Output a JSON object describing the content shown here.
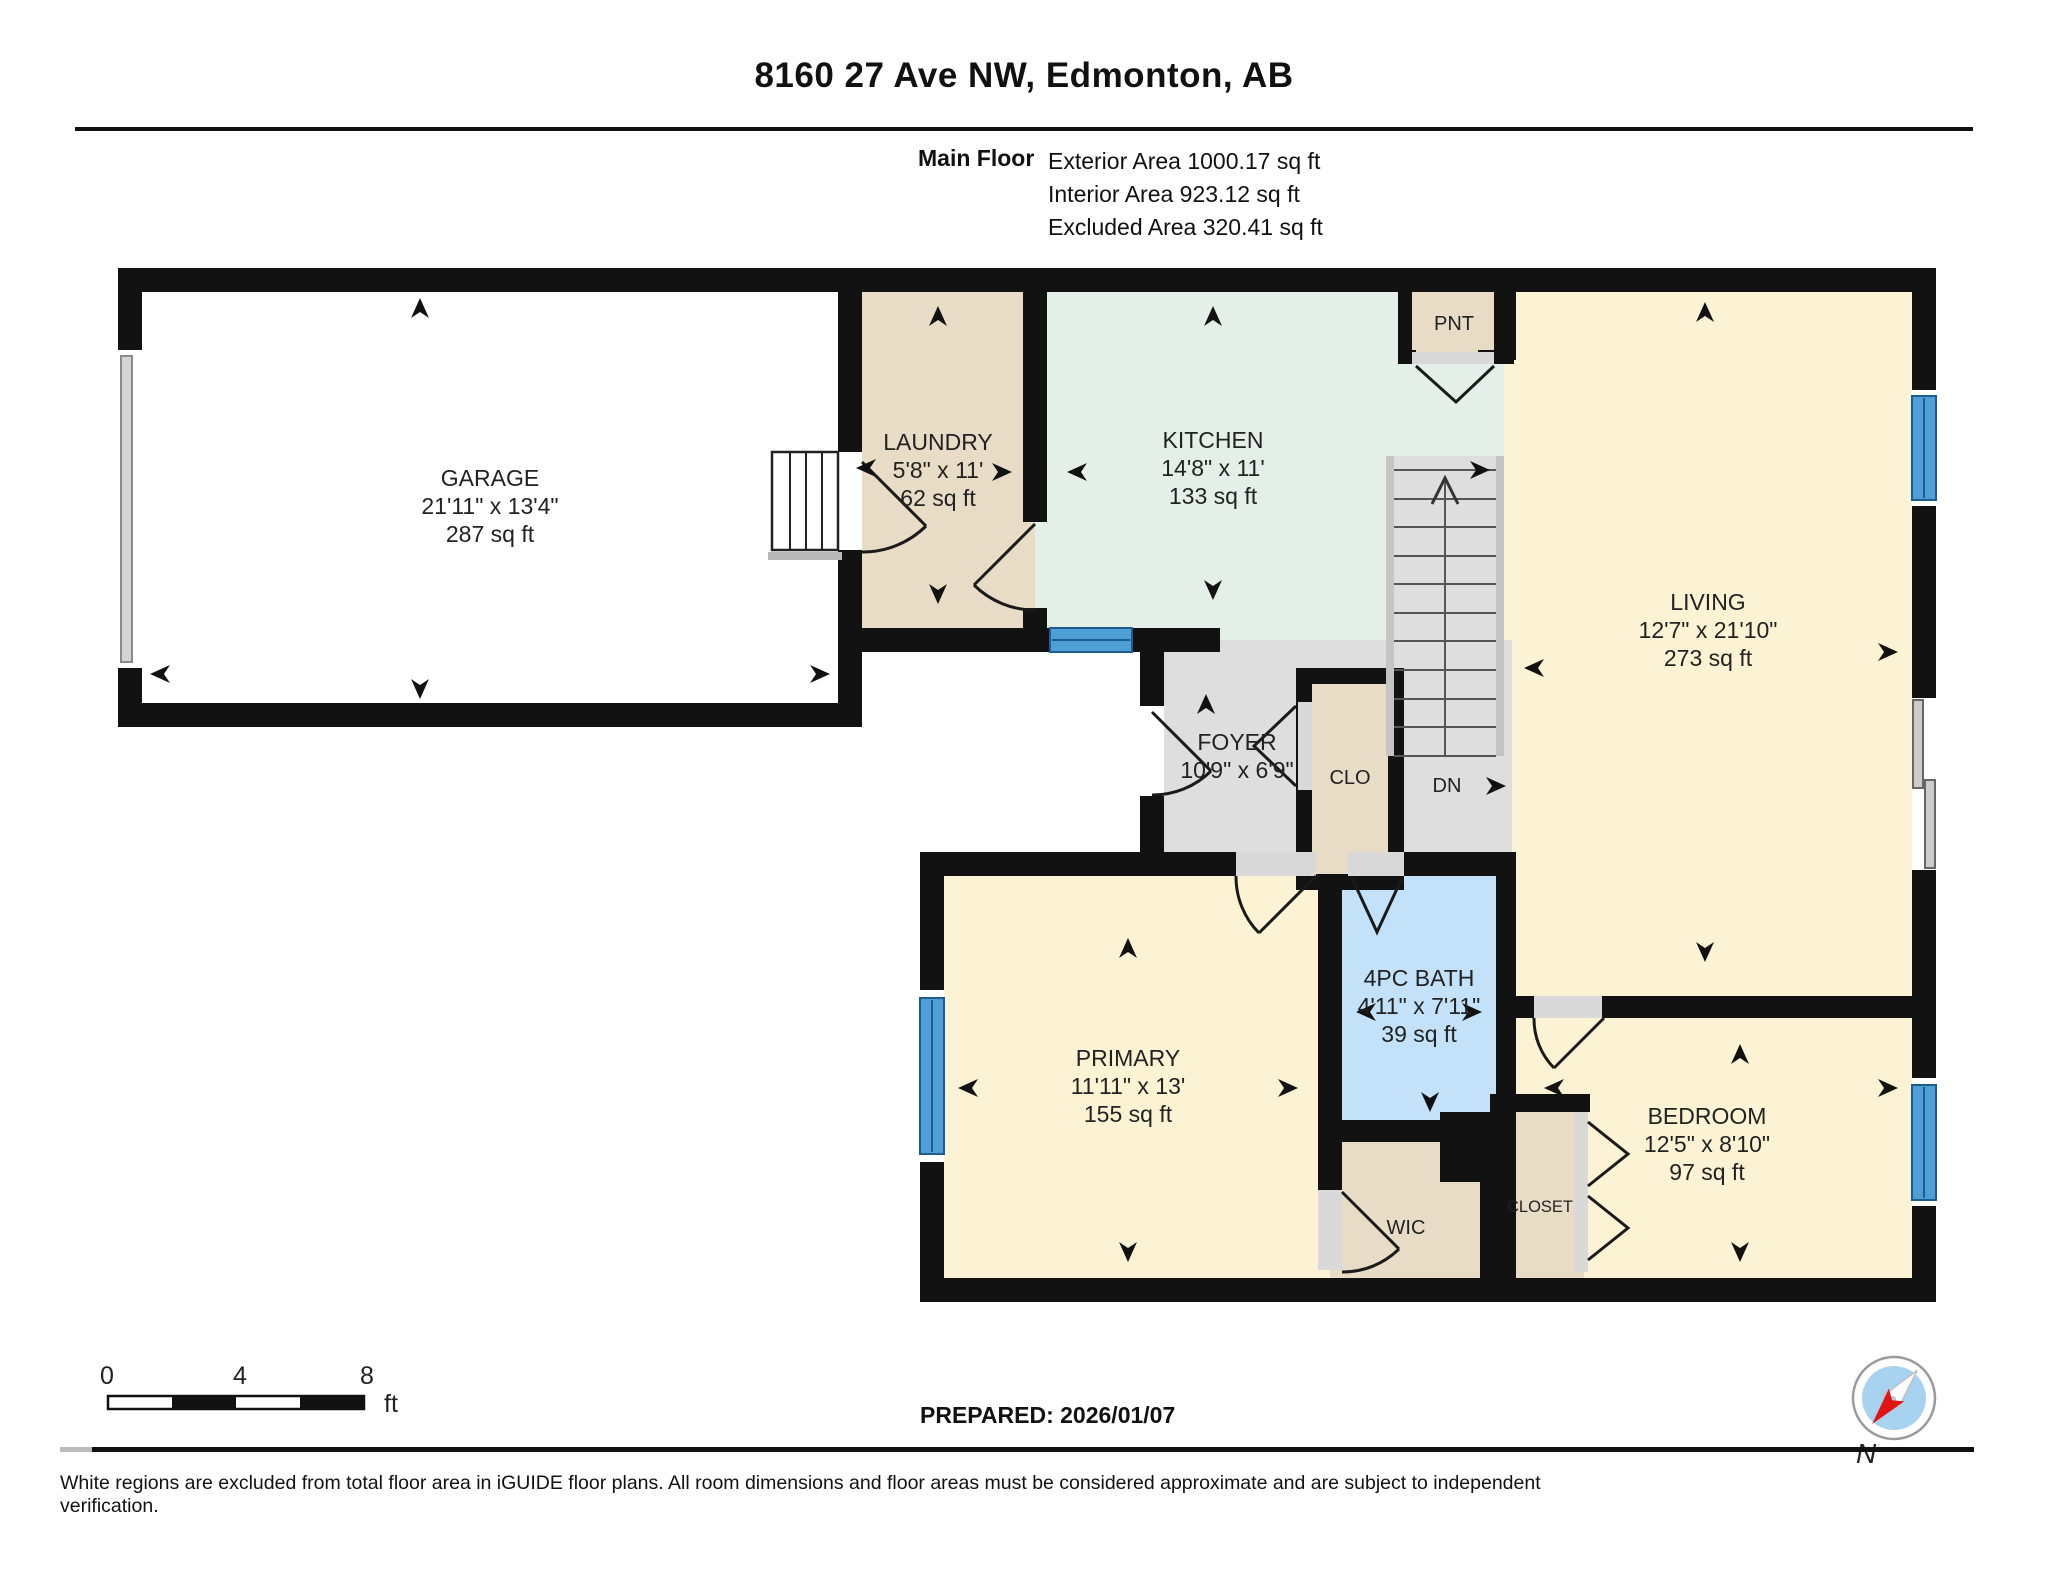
{
  "header": {
    "title": "8160 27 Ave NW, Edmonton, AB",
    "floor_label": "Main Floor",
    "exterior_area": "Exterior Area 1000.17 sq ft",
    "interior_area": "Interior Area 923.12 sq ft",
    "excluded_area": "Excluded Area 320.41 sq ft"
  },
  "rooms": {
    "garage": {
      "name": "GARAGE",
      "dims": "21'11\" x 13'4\"",
      "area": "287 sq ft"
    },
    "laundry": {
      "name": "LAUNDRY",
      "dims": "5'8\" x 11'",
      "area": "62 sq ft"
    },
    "kitchen": {
      "name": "KITCHEN",
      "dims": "14'8\" x 11'",
      "area": "133 sq ft"
    },
    "pantry": {
      "name": "PNT"
    },
    "living": {
      "name": "LIVING",
      "dims": "12'7\" x 21'10\"",
      "area": "273 sq ft"
    },
    "foyer": {
      "name": "FOYER",
      "dims": "10'9\" x 6'9\""
    },
    "closet_foyer": {
      "name": "CLO"
    },
    "stairs": {
      "down_label": "DN"
    },
    "primary": {
      "name": "PRIMARY",
      "dims": "11'11\" x 13'",
      "area": "155 sq ft"
    },
    "bath": {
      "name": "4PC BATH",
      "dims": "4'11\" x 7'11\"",
      "area": "39 sq ft"
    },
    "bedroom": {
      "name": "BEDROOM",
      "dims": "12'5\" x 8'10\"",
      "area": "97 sq ft"
    },
    "wic": {
      "name": "WIC"
    },
    "closet_bedroom": {
      "name": "CLOSET"
    }
  },
  "scale_bar": {
    "start": "0",
    "mid": "4",
    "end": "8",
    "unit": "ft"
  },
  "footer": {
    "prepared": "PREPARED: 2026/01/07",
    "compass_label": "N",
    "disclaimer": "White regions are excluded from total floor area in iGUIDE floor plans. All room dimensions and floor areas must be considered approximate and are subject to independent verification."
  },
  "colors": {
    "wall": "#121212",
    "closet_tan": "#e9dcc6",
    "kitchen_green": "#e4efe7",
    "room_cream": "#fcf3d4",
    "bath_blue": "#c3e2fa",
    "floor_gray": "#dedede",
    "window_blue": "#4d9fd6",
    "compass_red": "#e01414"
  }
}
